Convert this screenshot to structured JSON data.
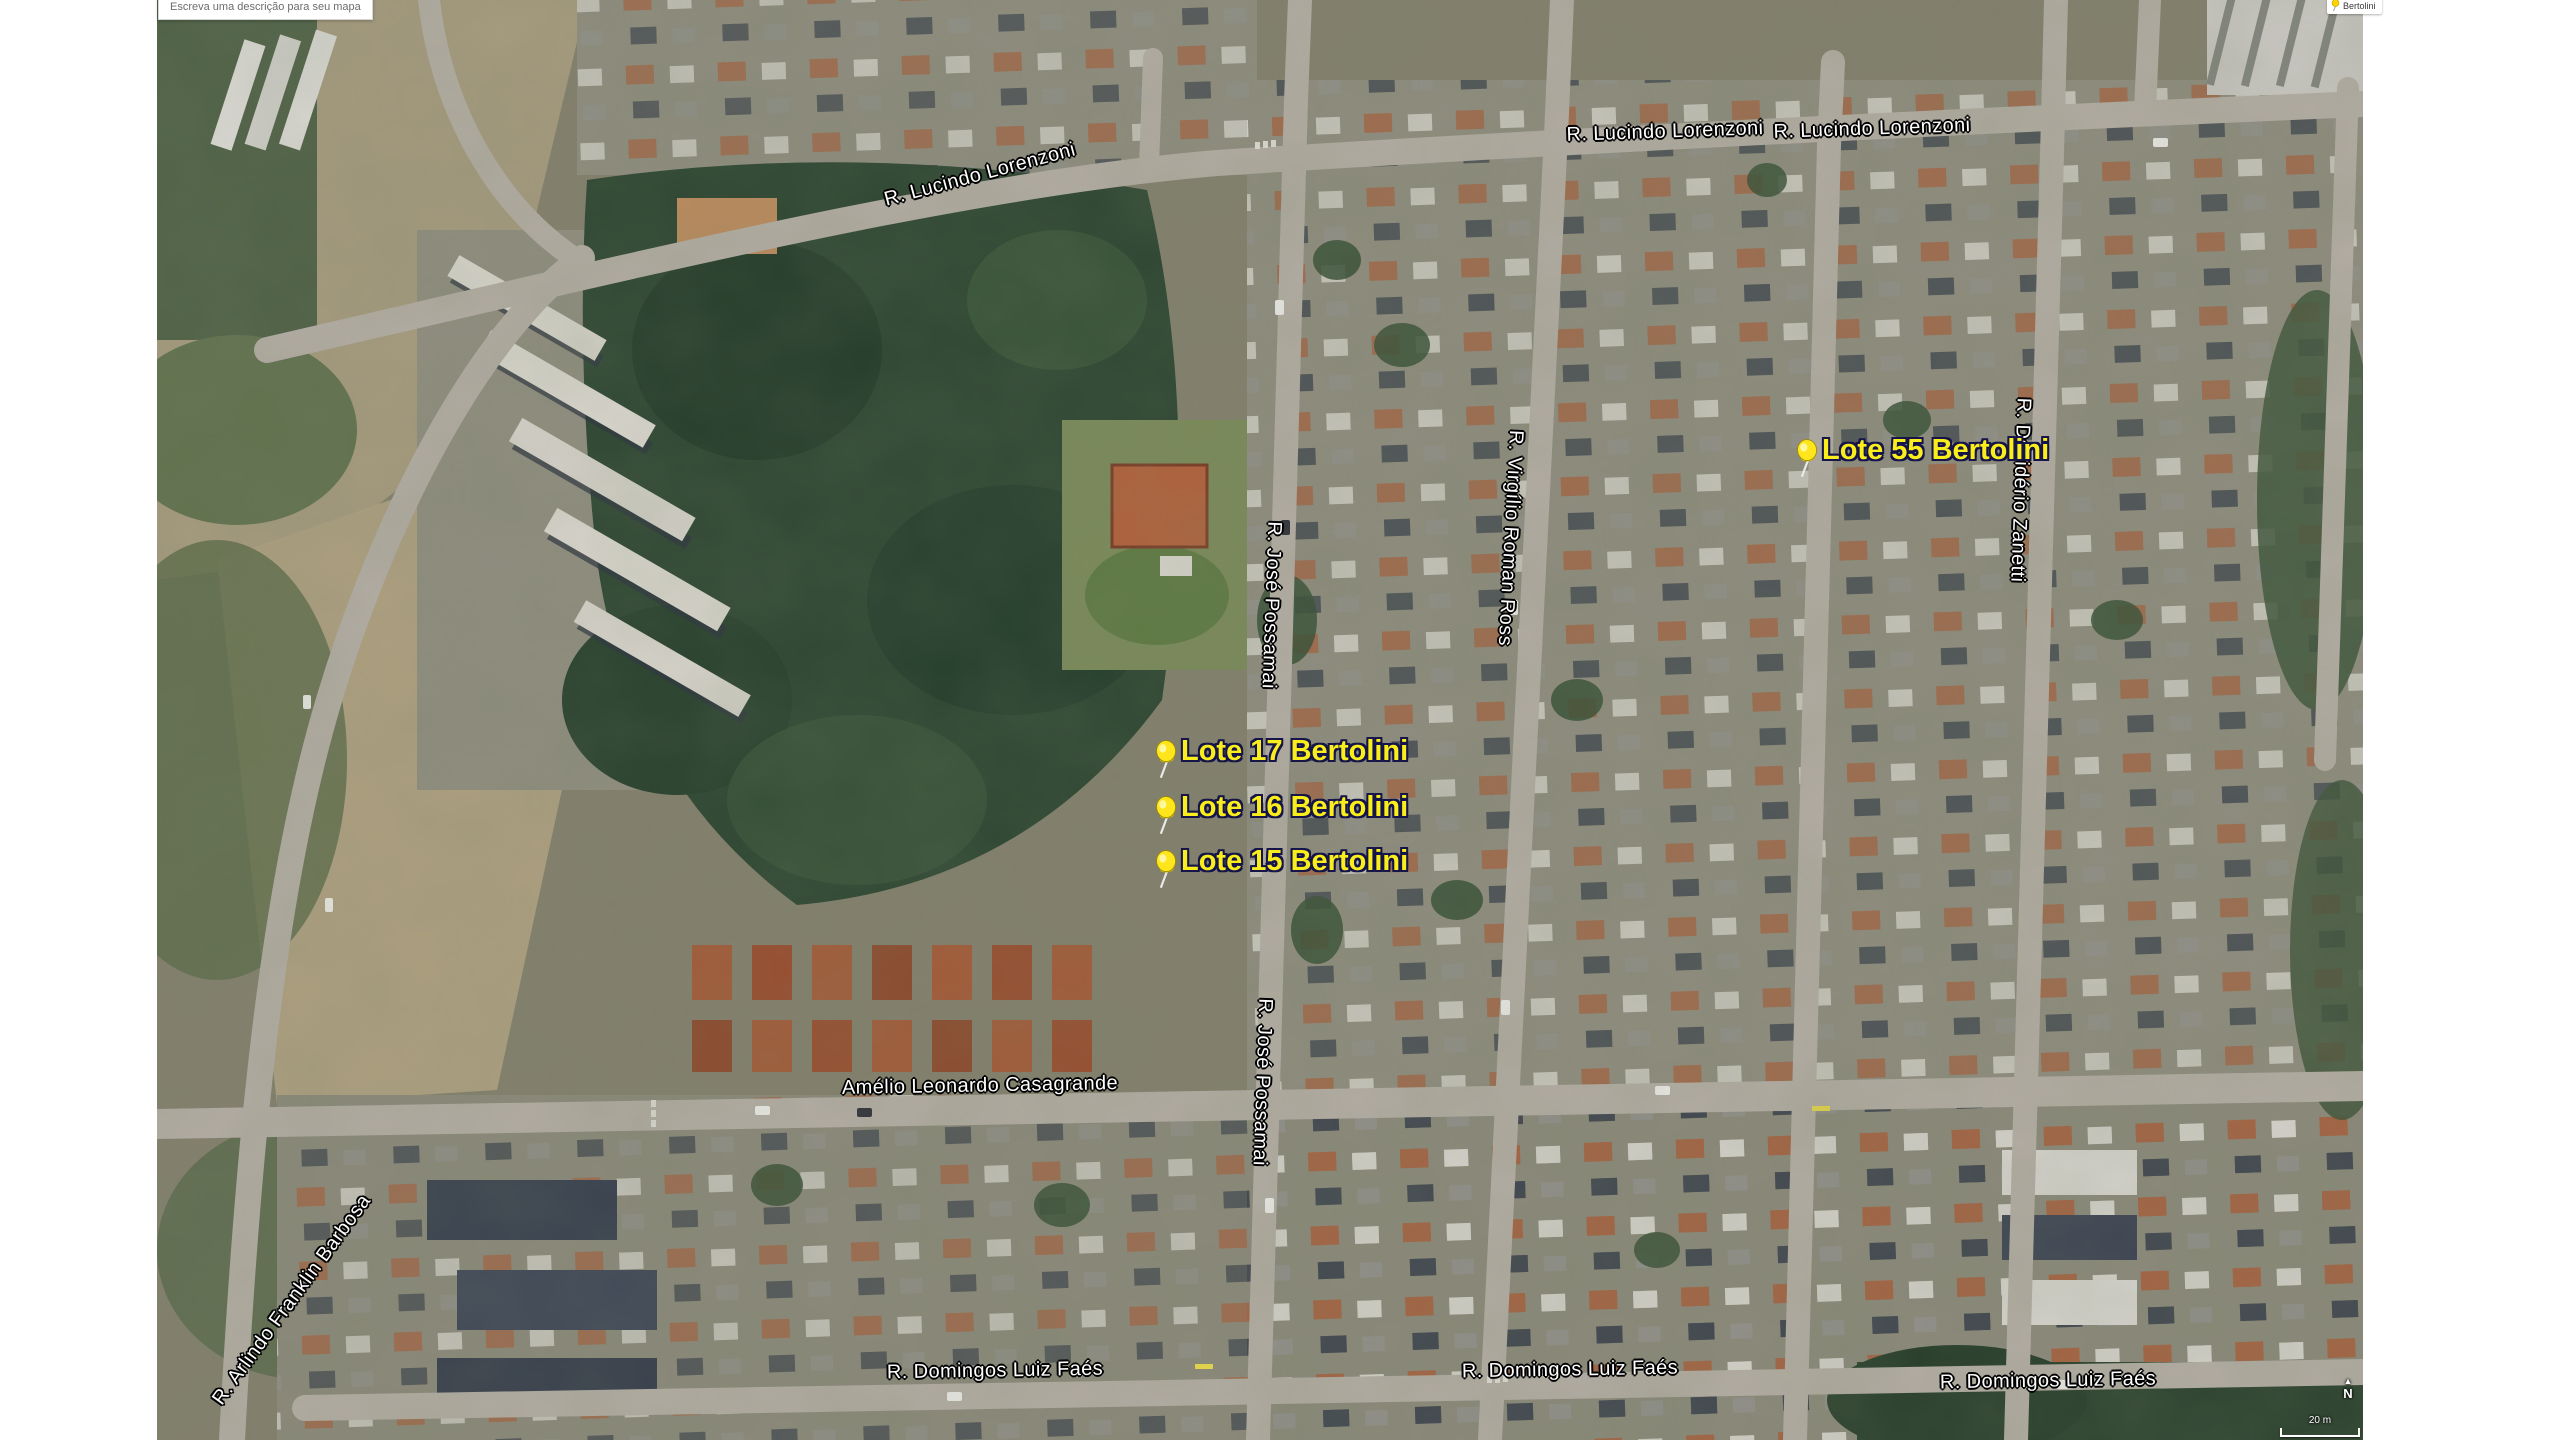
{
  "map_overlay": {
    "tooltip_text": "Escreva uma descrição para seu mapa",
    "legend_label": "Bertolini"
  },
  "streets": [
    {
      "id": "lucindo-lorenzoni-west",
      "text": "R. Lucindo Lorenzoni"
    },
    {
      "id": "lucindo-lorenzoni-mid",
      "text": "R. Lucindo Lorenzoni"
    },
    {
      "id": "lucindo-lorenzoni-east",
      "text": "R. Lucindo Lorenzoni"
    },
    {
      "id": "jose-possamai-north",
      "text": "R. José Possamai"
    },
    {
      "id": "virgilio-roman-ross",
      "text": "R. Virgílio Roman Ross"
    },
    {
      "id": "desiderio-zanetti",
      "text": "R. Desidério Zanetti"
    },
    {
      "id": "amelio-leonardo-casagrande",
      "text": "Amélio Leonardo Casagrande"
    },
    {
      "id": "jose-possamai-south",
      "text": "R. José Possamai"
    },
    {
      "id": "domingos-luiz-faes-west",
      "text": "R. Domingos Luiz Faés"
    },
    {
      "id": "domingos-luiz-faes-mid",
      "text": "R. Domingos Luiz Faés"
    },
    {
      "id": "domingos-luiz-faes-east",
      "text": "R. Domingos Luiz Faés"
    },
    {
      "id": "arlindo-franklin-barbosa",
      "text": "R. Arlindo Franklin Barbosa"
    }
  ],
  "markers": [
    {
      "label": "Lote 17 Bertolini"
    },
    {
      "label": "Lote 16 Bertolini"
    },
    {
      "label": "Lote 15 Bertolini"
    },
    {
      "label": "Lote 55 Bertolini"
    }
  ],
  "compass": {
    "arrow": "▲",
    "north_label": "N"
  },
  "scale": {
    "label": "20 m"
  },
  "colors": {
    "marker_yellow": "#f9ee1b",
    "street_label": "#ffffff",
    "label_outline": "#000000",
    "pin_label_outline": "#15154a"
  }
}
